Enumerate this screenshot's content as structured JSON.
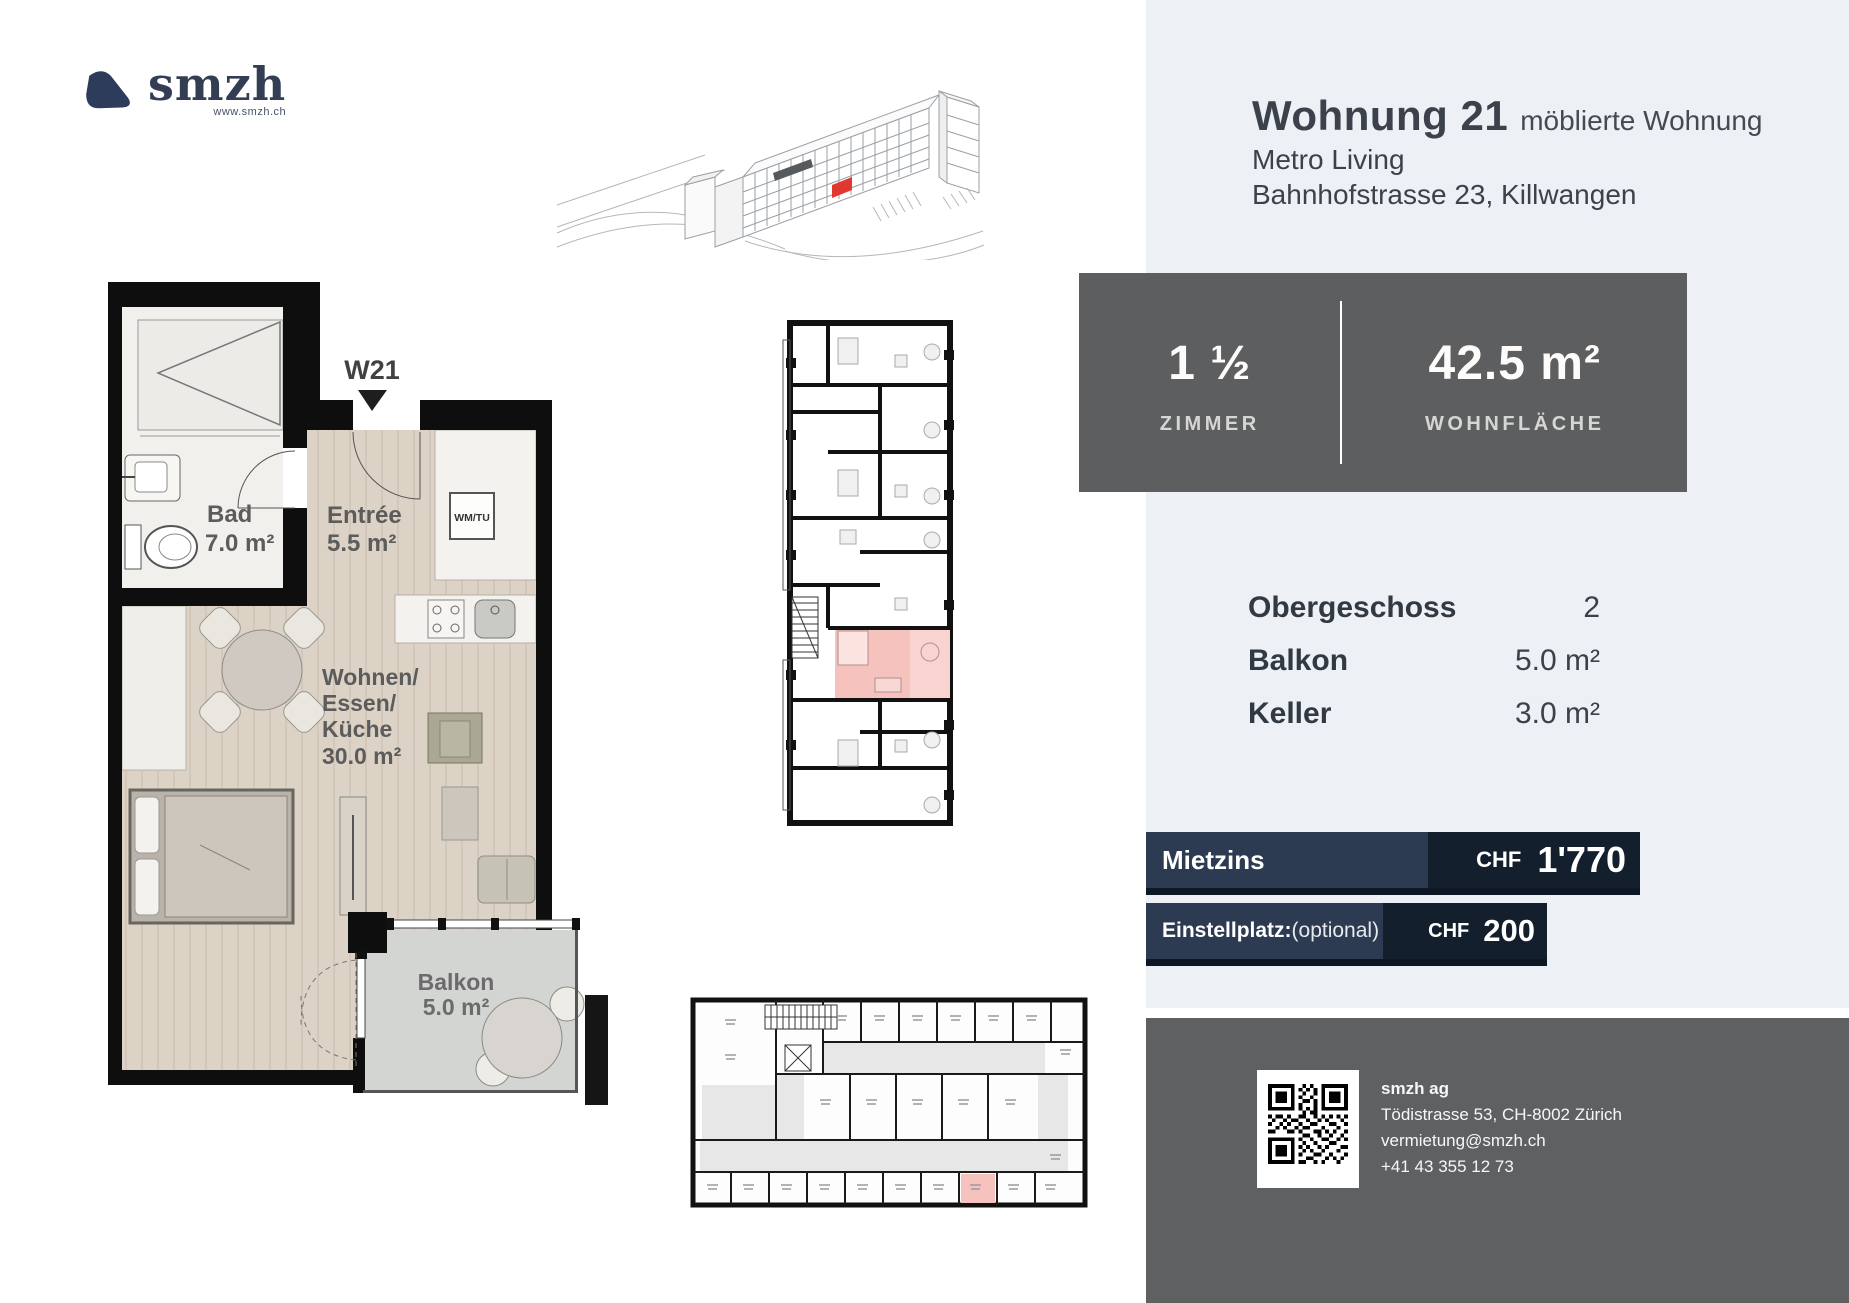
{
  "logo": {
    "brand": "smzh",
    "website": "www.smzh.ch"
  },
  "listing": {
    "title": "Wohnung 21",
    "title_suffix": "möblierte Wohnung",
    "project": "Metro Living",
    "address": "Bahnhofstrasse 23, Killwangen"
  },
  "stats": {
    "rooms": {
      "value": "1 ½",
      "label": "ZIMMER"
    },
    "area": {
      "value": "42.5 m²",
      "label": "WOHNFLÄCHE"
    }
  },
  "details": [
    {
      "label": "Obergeschoss",
      "value": "2"
    },
    {
      "label": "Balkon",
      "value": "5.0 m²"
    },
    {
      "label": "Keller",
      "value": "3.0 m²"
    }
  ],
  "pricing": {
    "rent": {
      "label": "Mietzins",
      "currency": "CHF",
      "amount": "1'770"
    },
    "parking": {
      "label": "Einstellplatz:",
      "note": "(optional)",
      "currency": "CHF",
      "amount": "200"
    }
  },
  "contact": {
    "company": "smzh ag",
    "address": "Tödistrasse 53, CH-8002 Zürich",
    "email": "vermietung@smzh.ch",
    "phone": "+41 43 355 12 73"
  },
  "floorplan": {
    "unit": "W21",
    "bad": {
      "name": "Bad",
      "area": "7.0 m²"
    },
    "entree": {
      "name": "Entrée",
      "area": "5.5 m²"
    },
    "living": {
      "line1": "Wohnen/",
      "line2": "Essen/",
      "line3": "Küche",
      "area": "30.0 m²"
    },
    "balkon": {
      "name": "Balkon",
      "area": "5.0 m²"
    },
    "closet": "WM/TU"
  },
  "colors": {
    "panel": "#edf0f4",
    "stats_box": "#5d5e60",
    "bar_navy": "#2d3b52",
    "bar_dark_navy": "#141f2d",
    "bar_shadow": "#0e1724",
    "footer": "#5f6062",
    "highlight_pink": "#f5c2bd",
    "highlight_red": "#e0382e",
    "text_dark": "#3a4149"
  }
}
